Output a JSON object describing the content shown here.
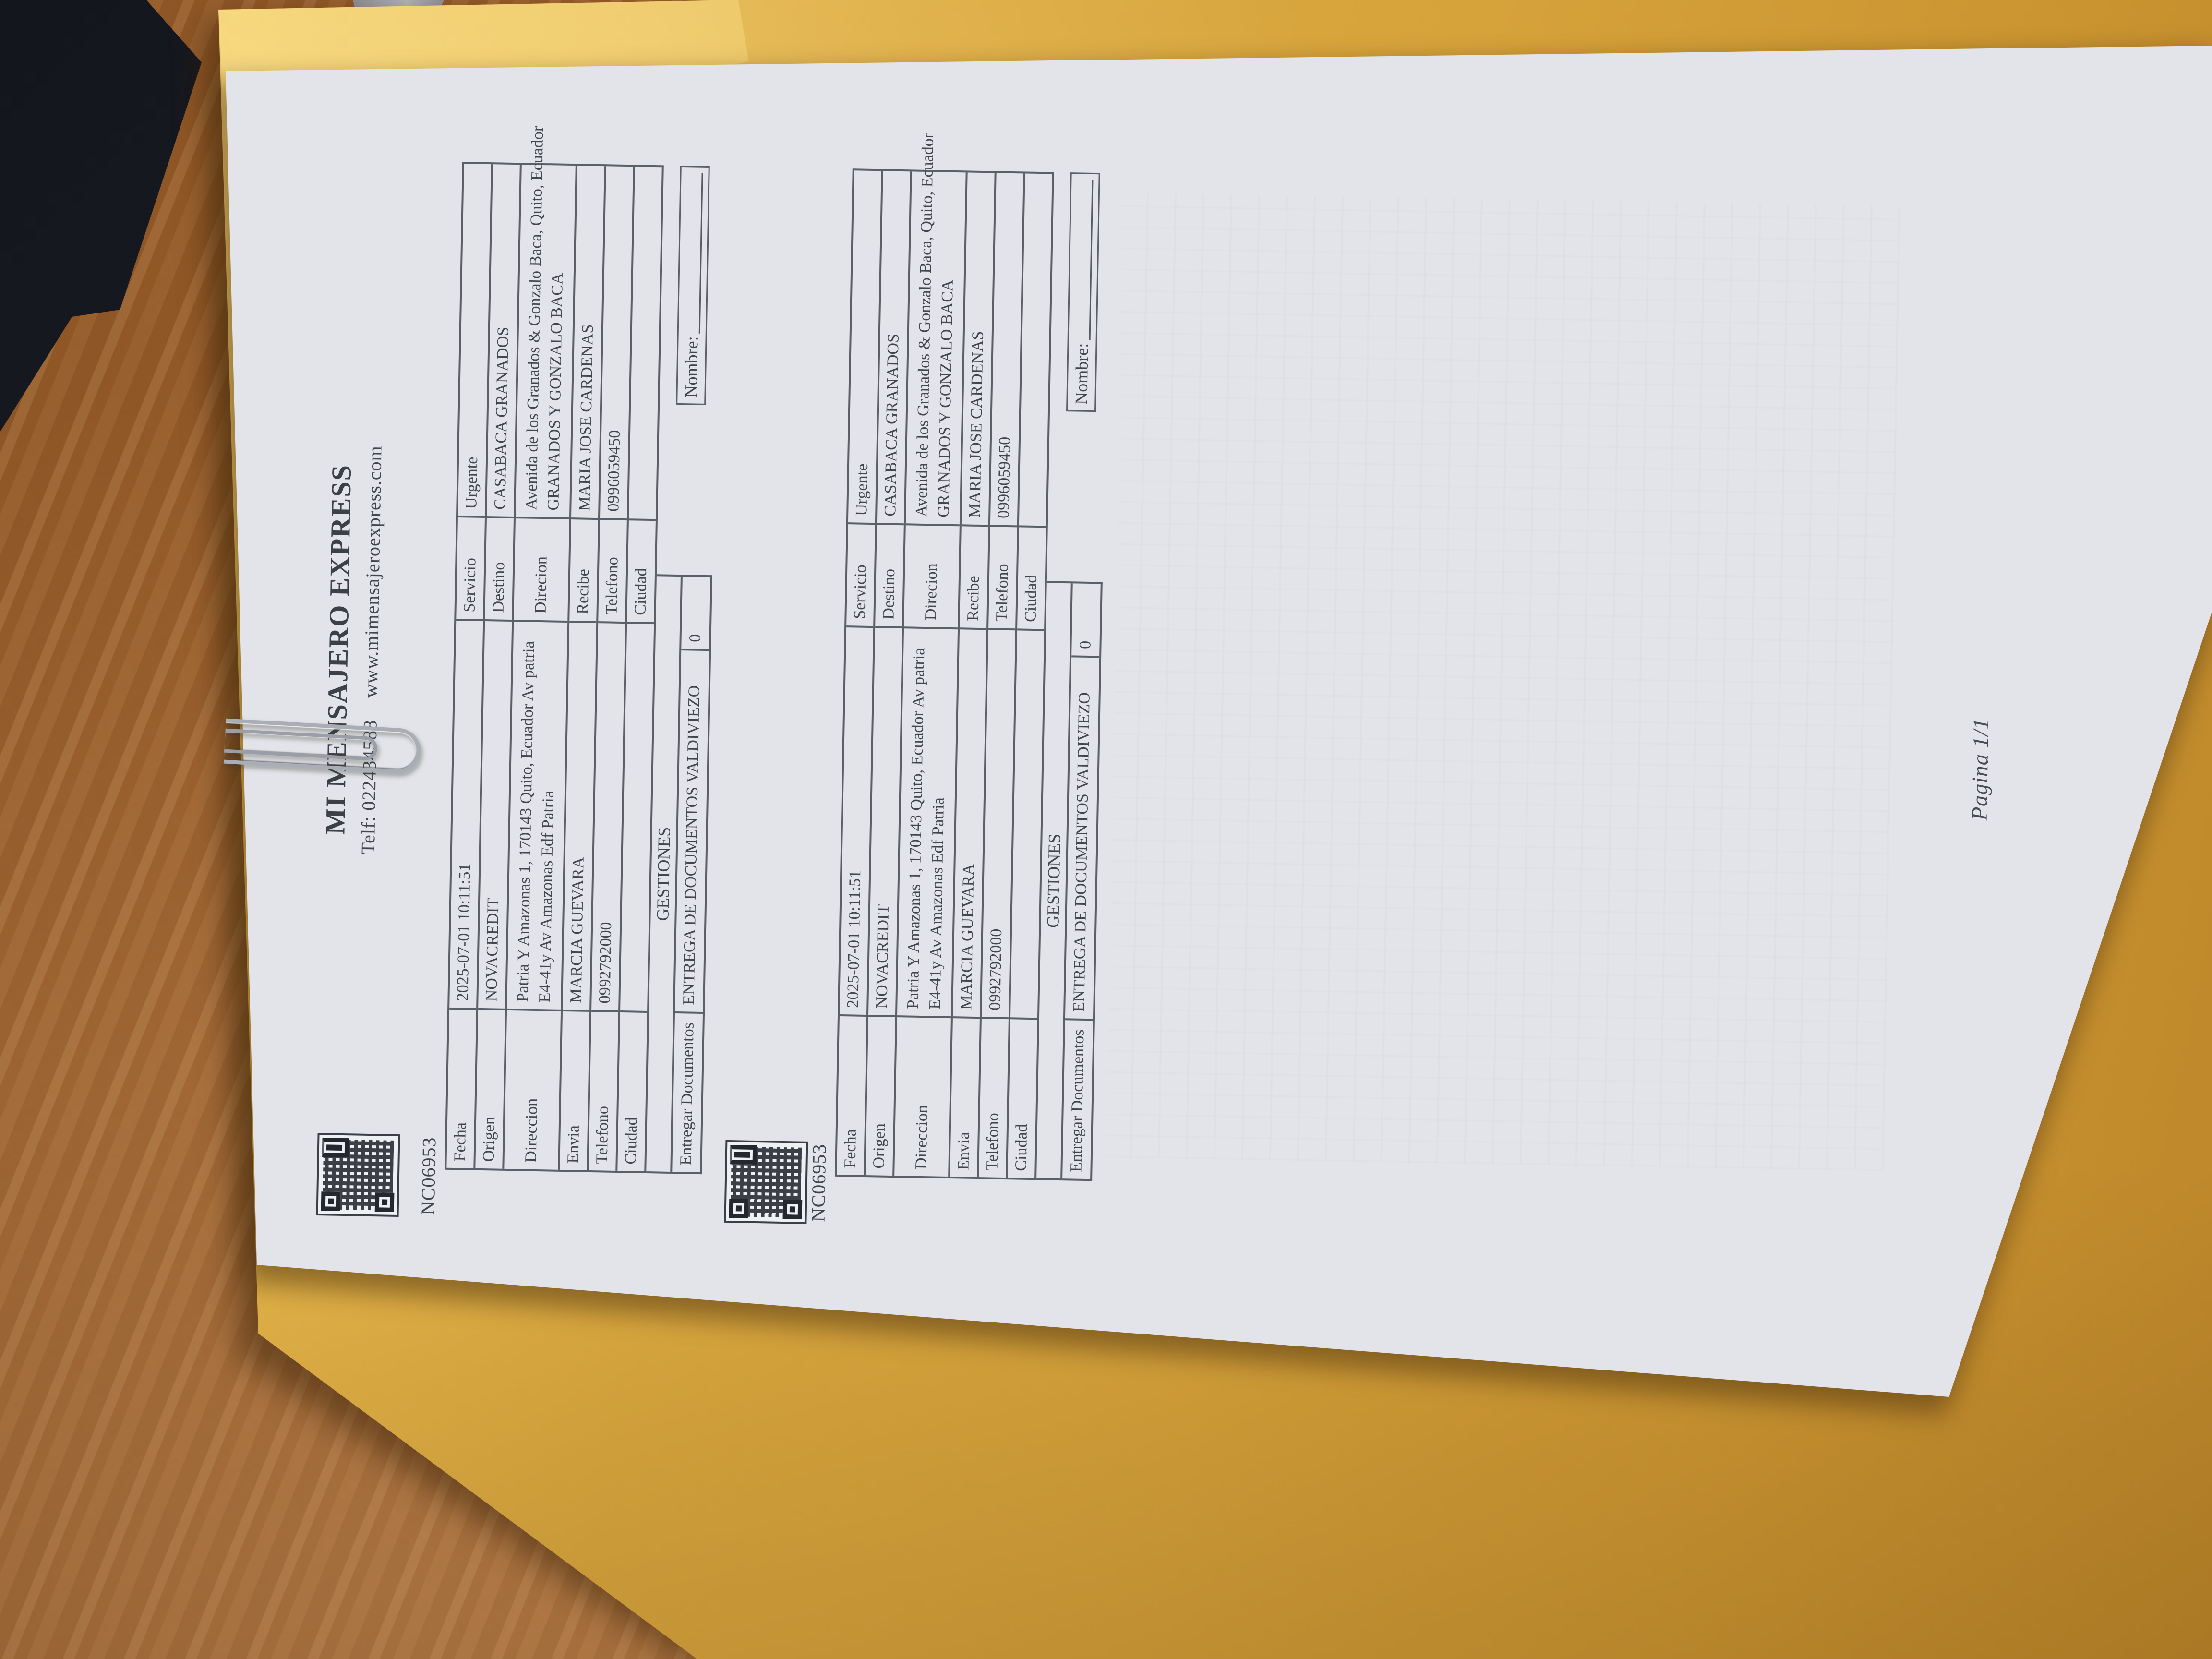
{
  "scene": {
    "desk_color": "#a4652e",
    "envelope_color": "#d6a23a",
    "paper_color": "#e2e4e9",
    "dark_object_color": "#1b1d26",
    "paperclip_color": "#a9adb5",
    "ink_color": "#41454d"
  },
  "document": {
    "header": {
      "company": "MI MENSAJERO EXPRESS",
      "phone": "Telf: 022434588",
      "website": "www.mimensajeroexpress.com"
    },
    "waybill": {
      "number": "NC06953",
      "fields": {
        "fecha_label": "Fecha",
        "fecha_value": "2025-07-01 10:11:51",
        "servicio_label": "Servicio",
        "servicio_value": "Urgente",
        "origen_label": "Origen",
        "origen_value": "NOVACREDIT",
        "destino_label": "Destino",
        "destino_value": "CASABACA GRANADOS",
        "direccion_origen_label": "Direccion",
        "direccion_origen_line1": "Patria Y Amazonas 1, 170143 Quito, Ecuador Av patria",
        "direccion_origen_line2": "E4-41y Av Amazonas Edf Patria",
        "direccion_destino_label": "Direcion",
        "direccion_destino_line1": "Avenida de los Granados & Gonzalo Baca, Quito, Ecuador",
        "direccion_destino_line2": "GRANADOS Y GONZALO BACA",
        "envia_label": "Envia",
        "envia_value": "MARCIA GUEVARA",
        "recibe_label": "Recibe",
        "recibe_value": "MARIA JOSE CARDENAS",
        "telefono_origen_label": "Telefono",
        "telefono_origen_value": "0992792000",
        "telefono_destino_label": "Telefono",
        "telefono_destino_value": "0996059450",
        "ciudad_origen_label": "Ciudad",
        "ciudad_origen_value": "",
        "ciudad_destino_label": "Ciudad",
        "ciudad_destino_value": "",
        "gestiones_header": "GESTIONES",
        "entregar_label": "Entregar Documentos",
        "entregar_value": "ENTREGA DE DOCUMENTOS VALDIVIEZO",
        "entregar_qty": "0",
        "nombre_label": "Nombre:"
      }
    },
    "footer": {
      "page": "Pagina 1/1"
    }
  }
}
